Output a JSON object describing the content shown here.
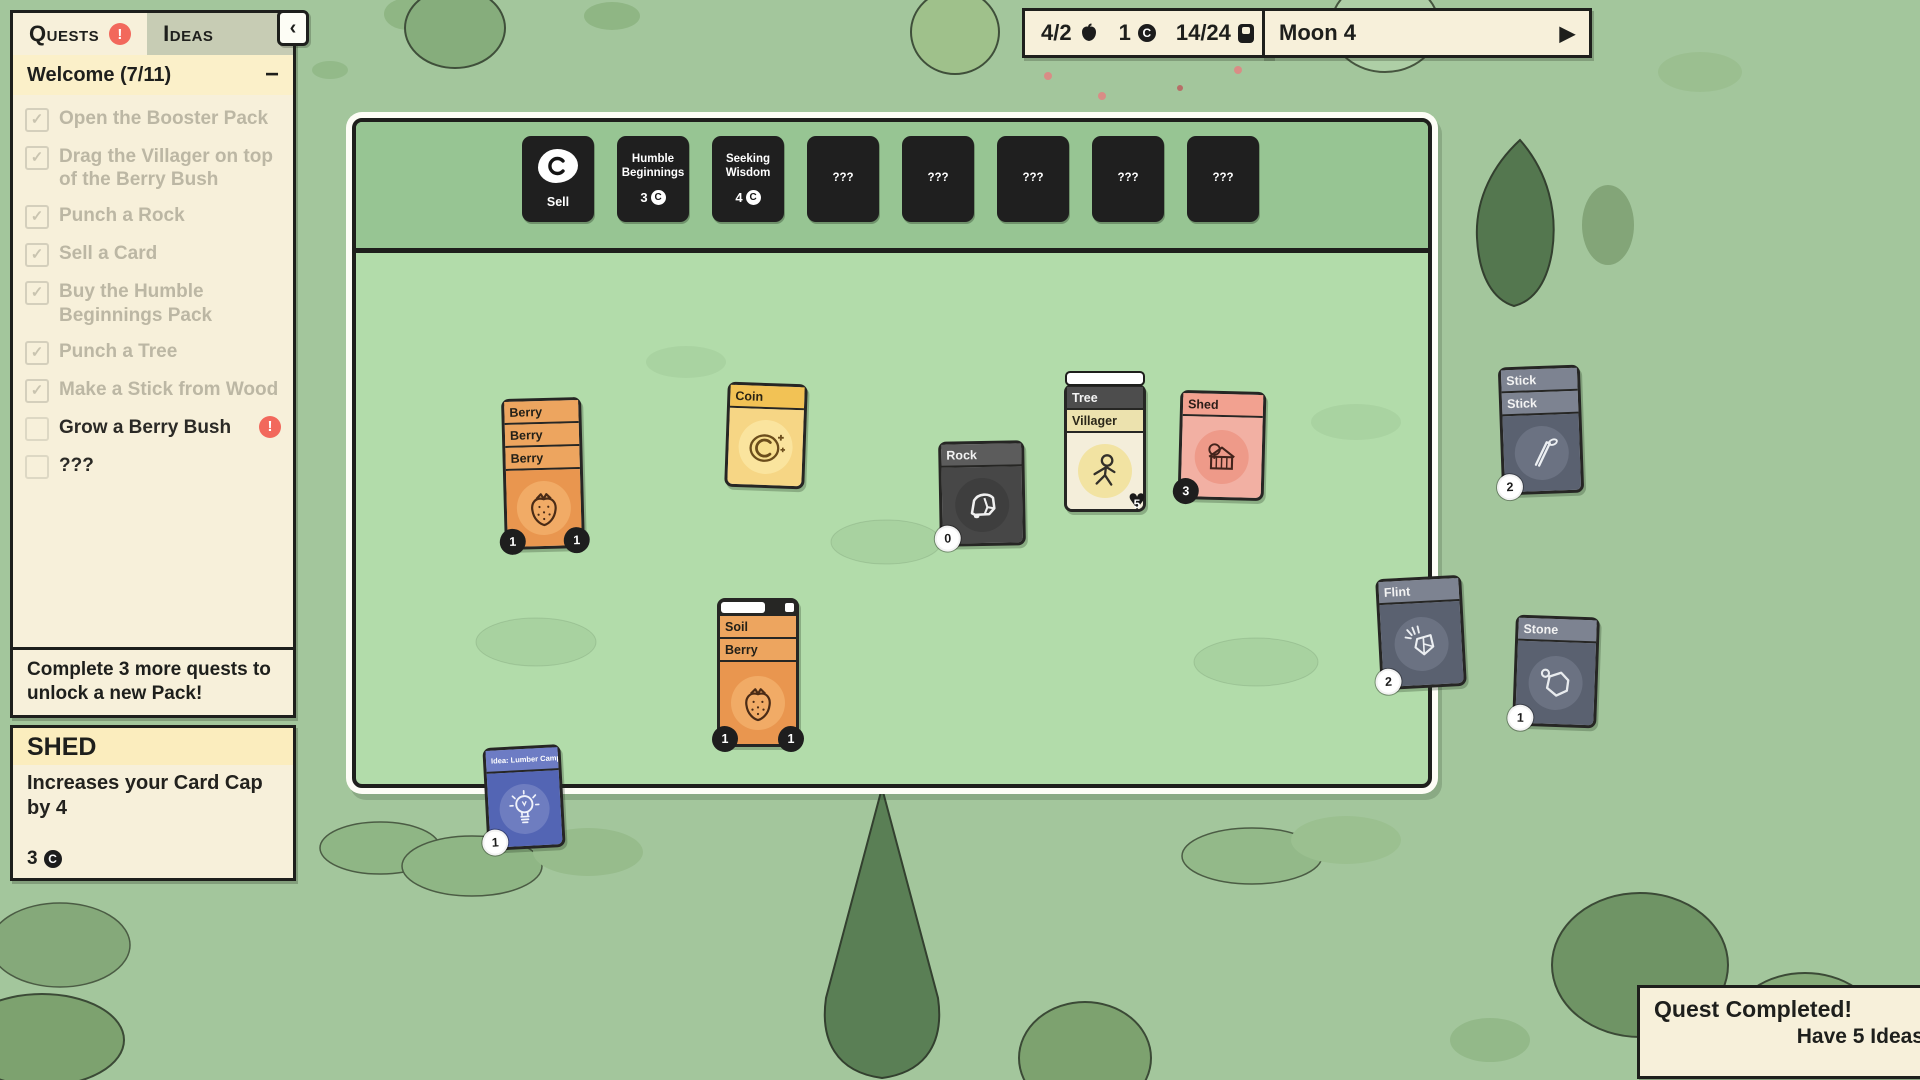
{
  "icons": {
    "check": "✓",
    "coin_letter": "C"
  },
  "ui": {
    "quests_tab": "Quests",
    "ideas_tab": "Ideas",
    "alert_glyph": "!",
    "collapse_chevron": "‹",
    "group": {
      "title": "Welcome (7/11)",
      "collapse": "−"
    },
    "completed_quests": [
      "Open the Booster Pack",
      "Drag the Villager on top of the Berry Bush",
      "Punch a Rock",
      "Sell a Card",
      "Buy the Humble Beginnings Pack",
      "Punch a Tree",
      "Make a Stick from Wood"
    ],
    "active_quests": [
      {
        "label": "Grow a Berry Bush",
        "alert": "!"
      },
      {
        "label": "???"
      }
    ],
    "quests_footer": "Complete 3 more quests to unlock a new Pack!"
  },
  "card_info": {
    "title": "SHED",
    "description": "Increases your Card Cap by 4",
    "price": "3"
  },
  "top_bar": {
    "cards": "4/2",
    "coins": "1",
    "card_cap": "14/24"
  },
  "moon": {
    "label": "Moon 4",
    "play": "▶"
  },
  "packs": {
    "sell": {
      "label": "Sell"
    },
    "row": [
      {
        "name": "Humble Beginnings",
        "cost": "3"
      },
      {
        "name": "Seeking Wisdom",
        "cost": "4"
      },
      {
        "name": "???"
      },
      {
        "name": "???"
      },
      {
        "name": "???"
      },
      {
        "name": "???"
      },
      {
        "name": "???"
      }
    ]
  },
  "cards": {
    "berry_stack": {
      "titles": [
        "Berry",
        "Berry",
        "Berry"
      ],
      "badge_left": "1",
      "badge_right": "1"
    },
    "coin": {
      "title": "Coin"
    },
    "rock": {
      "title": "Rock",
      "badge": "0"
    },
    "tree_villager": {
      "top_title": "Tree",
      "title": "Villager",
      "heart": "5"
    },
    "shed": {
      "title": "Shed",
      "badge": "3"
    },
    "stick_stack": {
      "titles": [
        "Stick",
        "Stick"
      ],
      "badge": "2"
    },
    "soil_berry": {
      "top_title": "Soil",
      "title": "Berry",
      "badge_left": "1",
      "badge_right": "1"
    },
    "flint": {
      "title": "Flint",
      "badge": "2"
    },
    "stone": {
      "title": "Stone",
      "badge": "1"
    },
    "idea": {
      "title": "Idea: Lumber Camp",
      "badge": "1"
    }
  },
  "notification": {
    "close": "X",
    "title": "Quest Completed!",
    "subtitle": "Have 5 Ideas"
  },
  "colors": {
    "accent_red": "#f2685c",
    "board_green": "#b2dcaa",
    "band_green": "#97c593",
    "outside_green": "#a3c69c",
    "panel_cream": "#f7f0da",
    "pack_dark": "#1f1f1f",
    "card_orange": "#e9964f",
    "card_gold": "#f6d685",
    "card_slate": "#5a6170",
    "card_pink": "#f2b0a3",
    "card_indigo": "#5365b4"
  }
}
